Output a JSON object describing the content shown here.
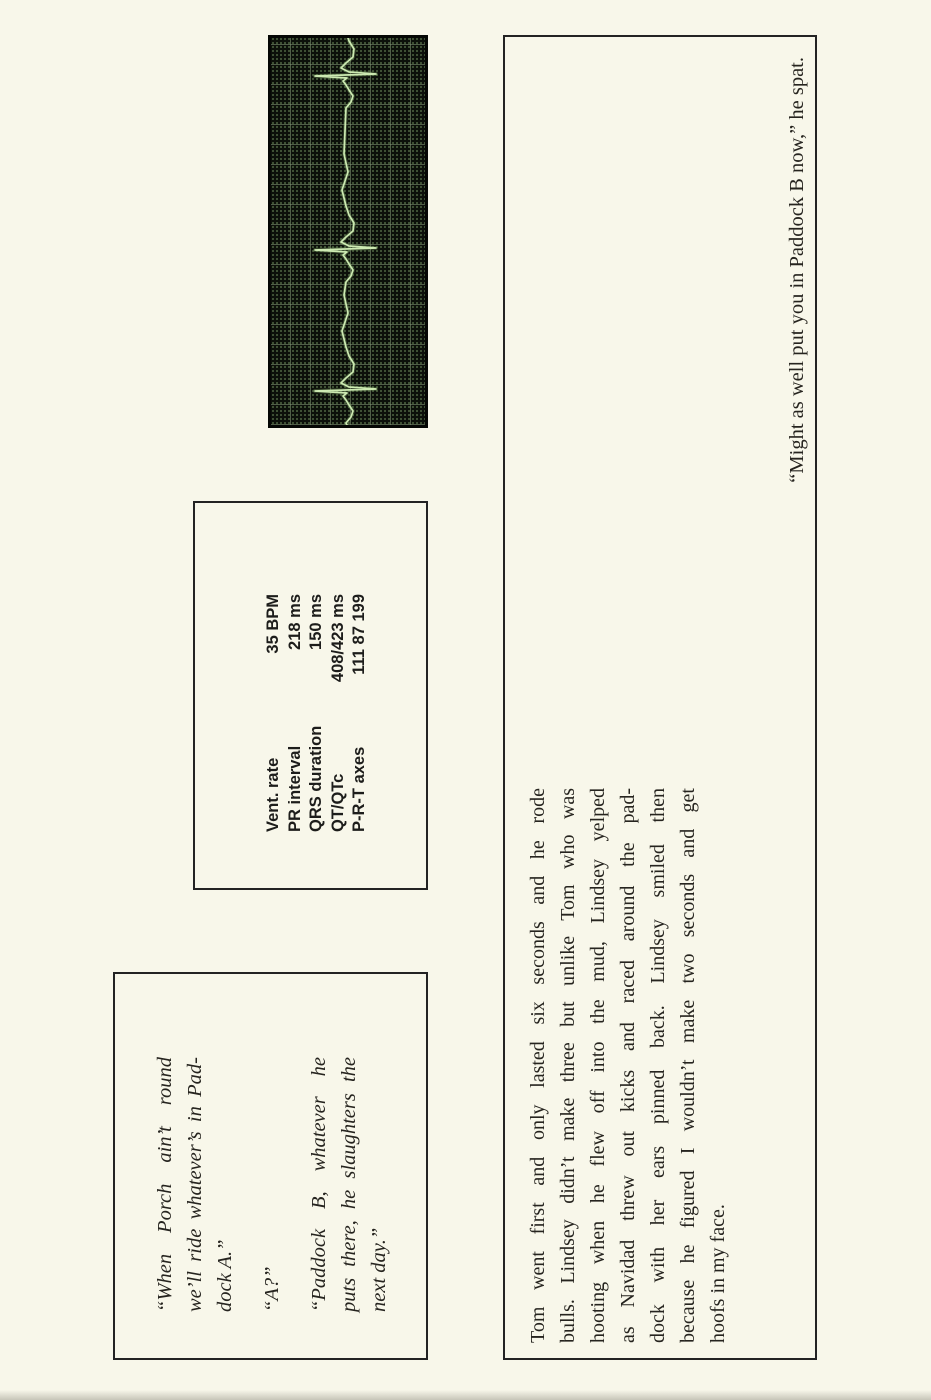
{
  "page": {
    "background": "#f8f7ea",
    "box_border": "#232323",
    "text_color": "#26241f",
    "edge_shadow": "rgba(70,68,58,0.28)"
  },
  "dialogue_box": {
    "paragraphs": [
      {
        "lines": [
          "“When Porch ain’t round",
          "we’ll ride whatever’s in Pad-",
          "dock A.”"
        ]
      },
      {
        "lines": [
          "“A?”"
        ]
      },
      {
        "lines": [
          "“Paddock B, whatever he",
          "puts there, he slaughters the",
          "next day.”"
        ]
      }
    ]
  },
  "ecg_readings": {
    "rows": [
      {
        "label": "Vent. rate",
        "value": "35 BPM"
      },
      {
        "label": "PR interval",
        "value": "218 ms"
      },
      {
        "label": "QRS duration",
        "value": "150 ms"
      },
      {
        "label": "QT/QTc",
        "value": "408/423 ms"
      },
      {
        "label": "P-R-T axes",
        "value": "111 87 199"
      }
    ]
  },
  "ecg_strip": {
    "width": 387,
    "height": 154,
    "baseline_y": 74,
    "beats_x": [
      38,
      179,
      353
    ],
    "r_amp": 30,
    "s_amp": 31,
    "background": "#0c100a",
    "grid_major_color": "#52644a",
    "grid_dot_color": "#2e3d2a",
    "trace_color": "#cdeab2",
    "glow_color": "#7fa868"
  },
  "story_box": {
    "paragraph_lines": [
      "Tom went first and only lasted six seconds and he rode",
      "bulls. Lindsey didn’t make three but unlike Tom who was",
      "hooting when he flew off into the mud, Lindsey yelped",
      "as Navidad threw out kicks and raced around the pad-",
      "dock with her ears pinned back. Lindsey smiled then",
      "because he figured I wouldn’t make two seconds and get",
      "hoofs in my face."
    ],
    "closing_line": "“Might as well put you in Paddock B now,” he spat."
  }
}
